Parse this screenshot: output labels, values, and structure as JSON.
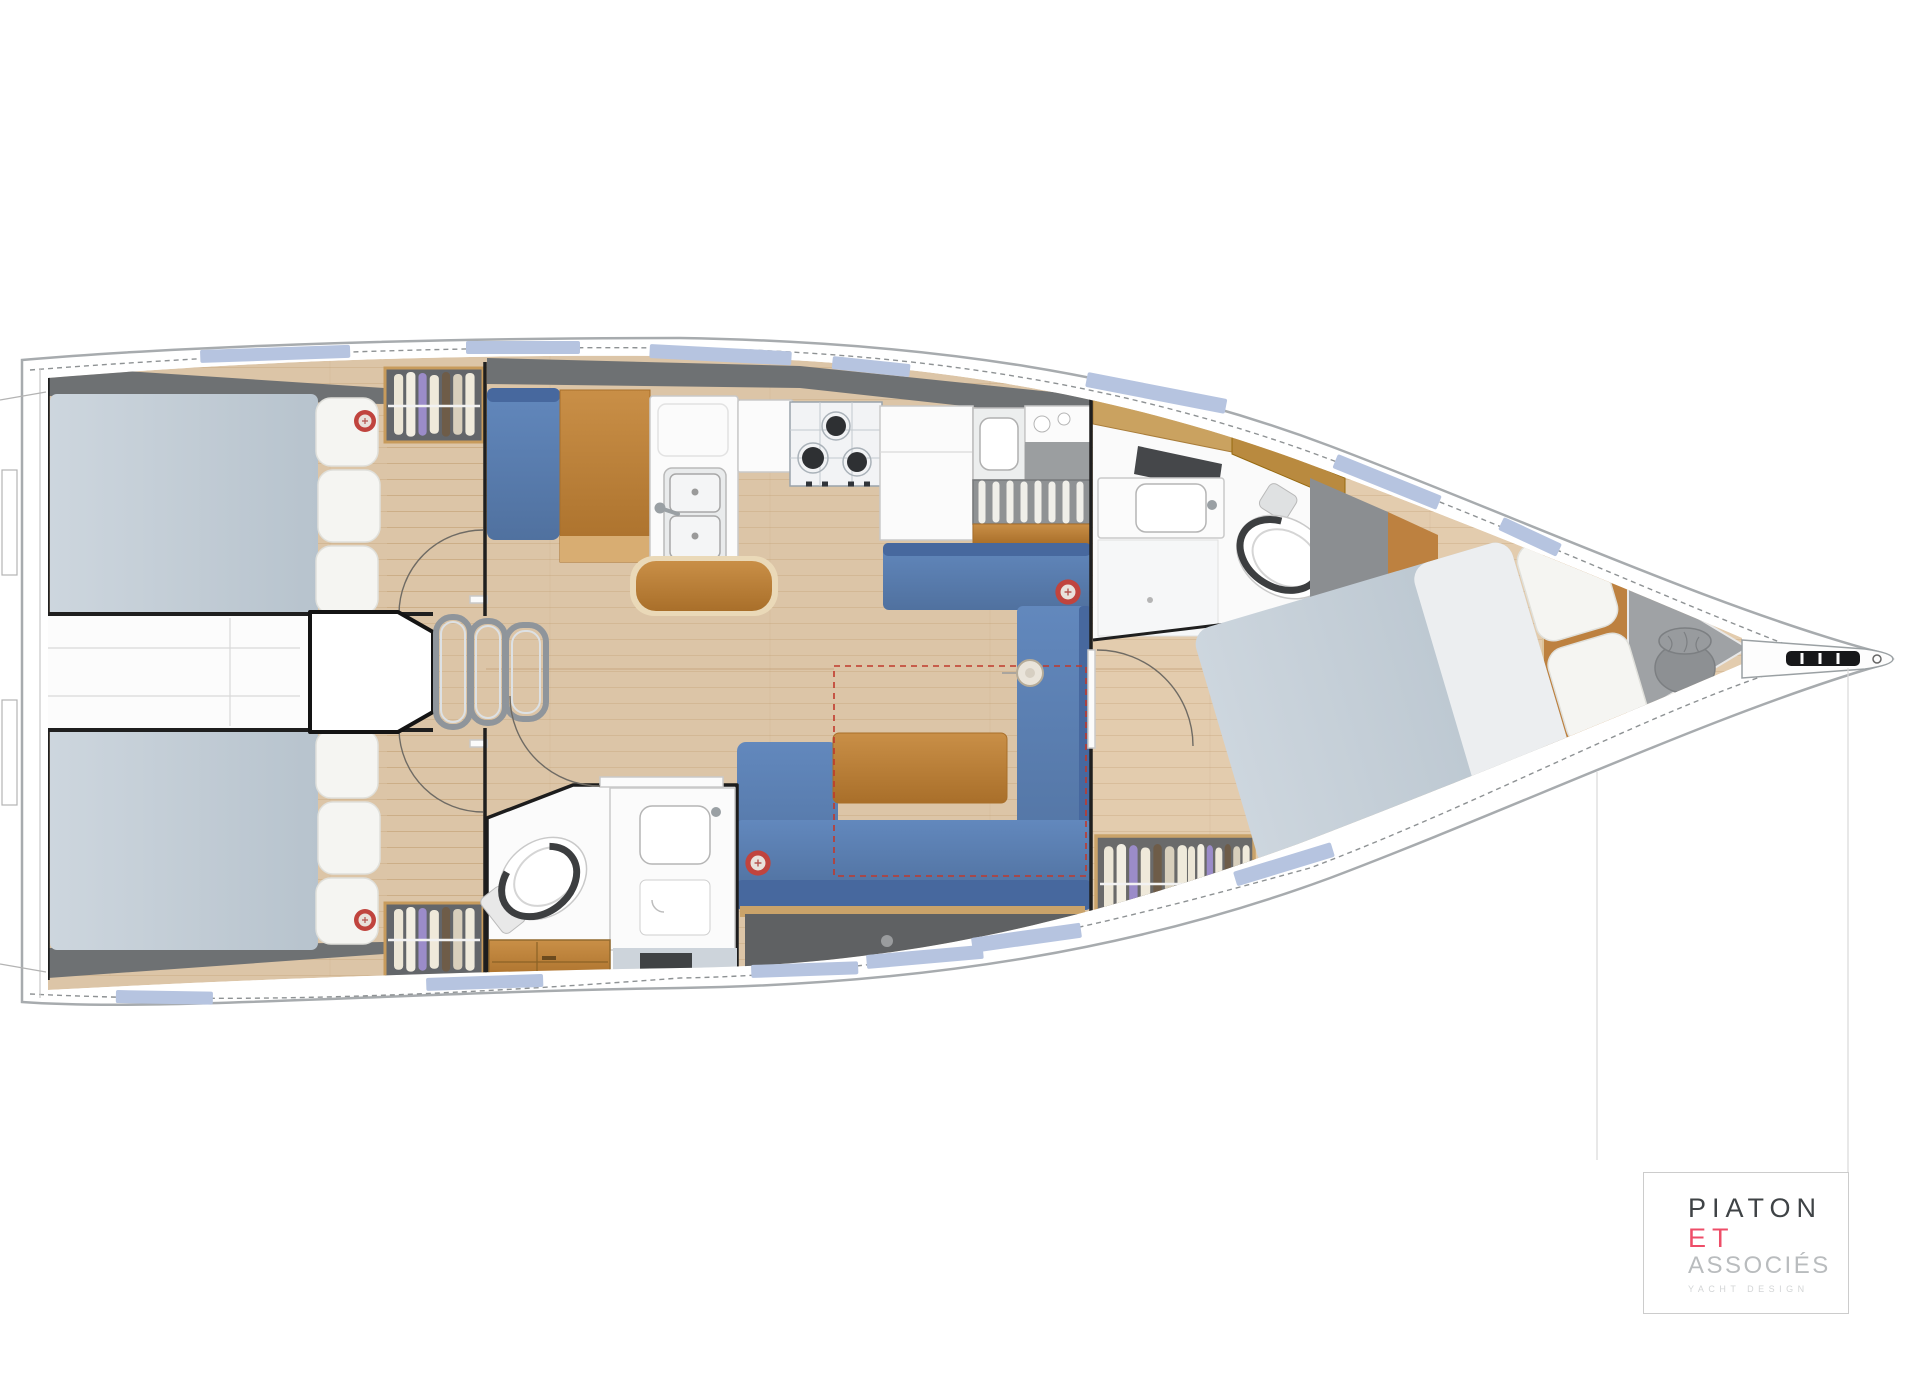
{
  "logo": {
    "name_top": "PIATON",
    "name_mid": "ET",
    "name_bottom": "ASSOCIÉS",
    "tagline": "YACHT DESIGN"
  },
  "palette": {
    "hull-fill": "#ffffff",
    "hull-line": "#a7abae",
    "sheer-dash": "#8e9294",
    "window": "#b6c4e0",
    "deck-dark": "#6e7173",
    "wall": "#1f1f1f",
    "floor": "#dcc5a7",
    "floor-fwd": "#e3ccae",
    "floor-line": "#c2a178",
    "mattress-1": "#cdd6de",
    "mattress-2": "#b7c3cd",
    "pillow": "#f5f5f2",
    "pillow-line": "#e0e0db",
    "sofa-1": "#6288bd",
    "sofa-2": "#50719f",
    "sofa-dark": "#47689e",
    "wood-1": "#c98f47",
    "wood-2": "#a96f2a",
    "wood-rim": "#ead9b8",
    "oak-trim": "#bd8140",
    "white-furn": "#fbfbfb",
    "furn-line": "#c9c9c9",
    "steel": "#8f959b",
    "steel-light": "#dde1e4",
    "counter-gray": "#9b9ea0",
    "rack-gray": "#8f9294",
    "storage-dark": "#5f6163",
    "locker-gray": "#9fa2a5",
    "bag-gray": "#8d9093",
    "red-accent": "#c0443e",
    "red-dash": "#c0392b",
    "toilet-ring": "#3c3e40",
    "logo-dark": "#3f4346",
    "logo-pink": "#ee4d68",
    "logo-gray": "#b9bcbe",
    "logo-faint": "#d3d5d6",
    "logo-border": "#cccccc"
  }
}
